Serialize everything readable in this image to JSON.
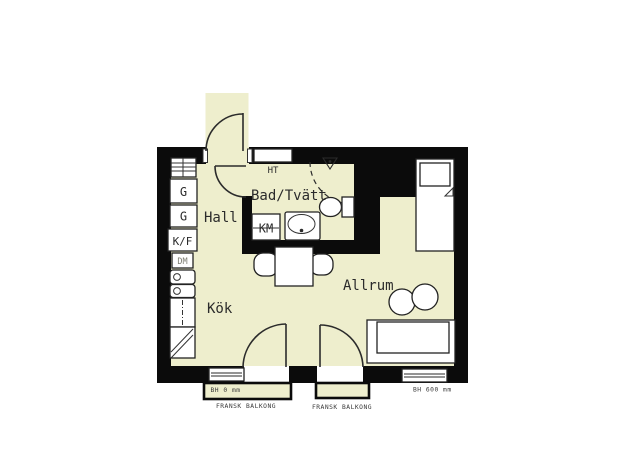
{
  "floorplan": {
    "rooms": {
      "hall": "Hall",
      "kitchen": "Kök",
      "living_room": "Allrum",
      "bathroom": "Bad/Tvätt"
    },
    "fixtures": {
      "wardrobe_1": "G",
      "wardrobe_2": "G",
      "fridge_freezer": "K/F",
      "dishwasher": "DM",
      "washing_machine": "KM",
      "towel_dryer": "HT"
    },
    "annotations": {
      "sill_height_left": "BH 0 mm",
      "sill_height_right": "BH 600 mm",
      "french_balcony_left": "FRANSK BALKONG",
      "french_balcony_right": "FRANSK BALKONG"
    },
    "colors": {
      "floor": "#eeeecd",
      "wall": "#0b0b0b",
      "outline": "#2b2b2b",
      "background": "#ffffff"
    }
  }
}
